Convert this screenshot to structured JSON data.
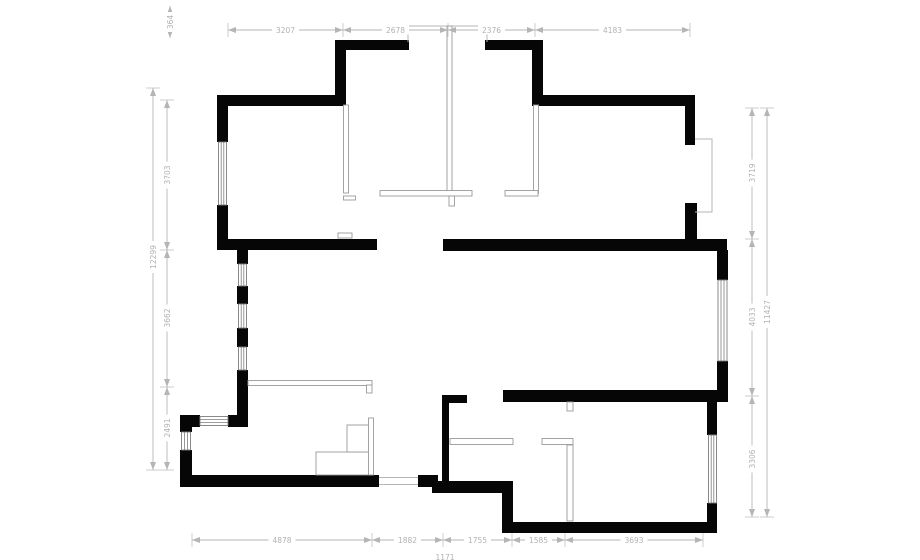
{
  "plan": {
    "background": "#ffffff",
    "wall_color": "#060606",
    "dimension_color": "#b5b5b5"
  },
  "dimensions": {
    "top": {
      "offset": {
        "label": "364"
      },
      "segments": [
        {
          "label": "3207"
        },
        {
          "label": "2678"
        },
        {
          "label": "2376"
        },
        {
          "label": "4183"
        }
      ]
    },
    "bottom": {
      "segments": [
        {
          "label": "4878"
        },
        {
          "label": "1882"
        },
        {
          "label": "1755"
        },
        {
          "label": "1585"
        },
        {
          "label": "3693"
        }
      ],
      "partial": {
        "label": "1171"
      }
    },
    "left": {
      "overall": {
        "label": "12299"
      },
      "segments": [
        {
          "label": "3703"
        },
        {
          "label": "3662"
        },
        {
          "label": "2491"
        }
      ]
    },
    "right": {
      "overall": {
        "label": "11427"
      },
      "segments": [
        {
          "label": "3719"
        },
        {
          "label": "4033"
        },
        {
          "label": "3306"
        }
      ]
    }
  }
}
